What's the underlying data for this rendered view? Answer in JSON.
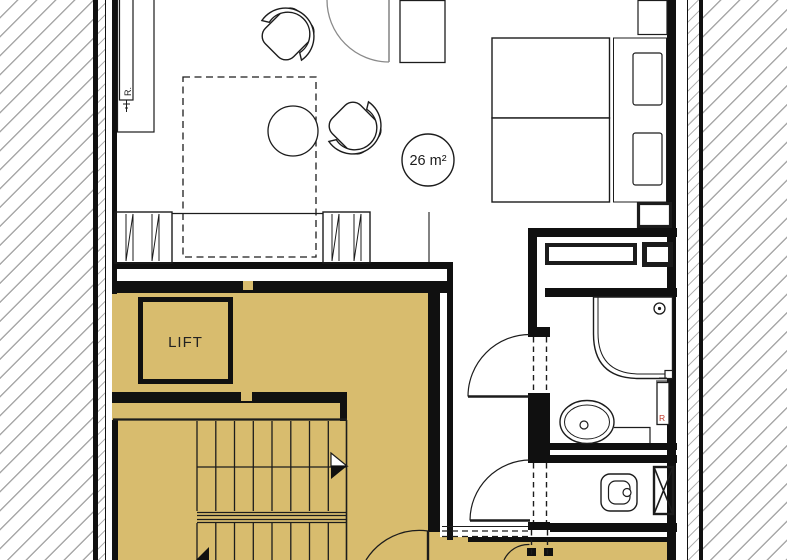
{
  "title": "apartment-floor-plan",
  "labels": {
    "lift": "LIFT",
    "area": "26 m²",
    "radiator_living": "R.",
    "radiator_bath": "R"
  },
  "colors": {
    "public_zone_fill": "#d8bc6e",
    "wall_black": "#101010",
    "hatch_line_gray": "#a8a8a8",
    "door_arc_gray": "#8a8a8a",
    "radiator_letter_red": "#c0392b"
  }
}
